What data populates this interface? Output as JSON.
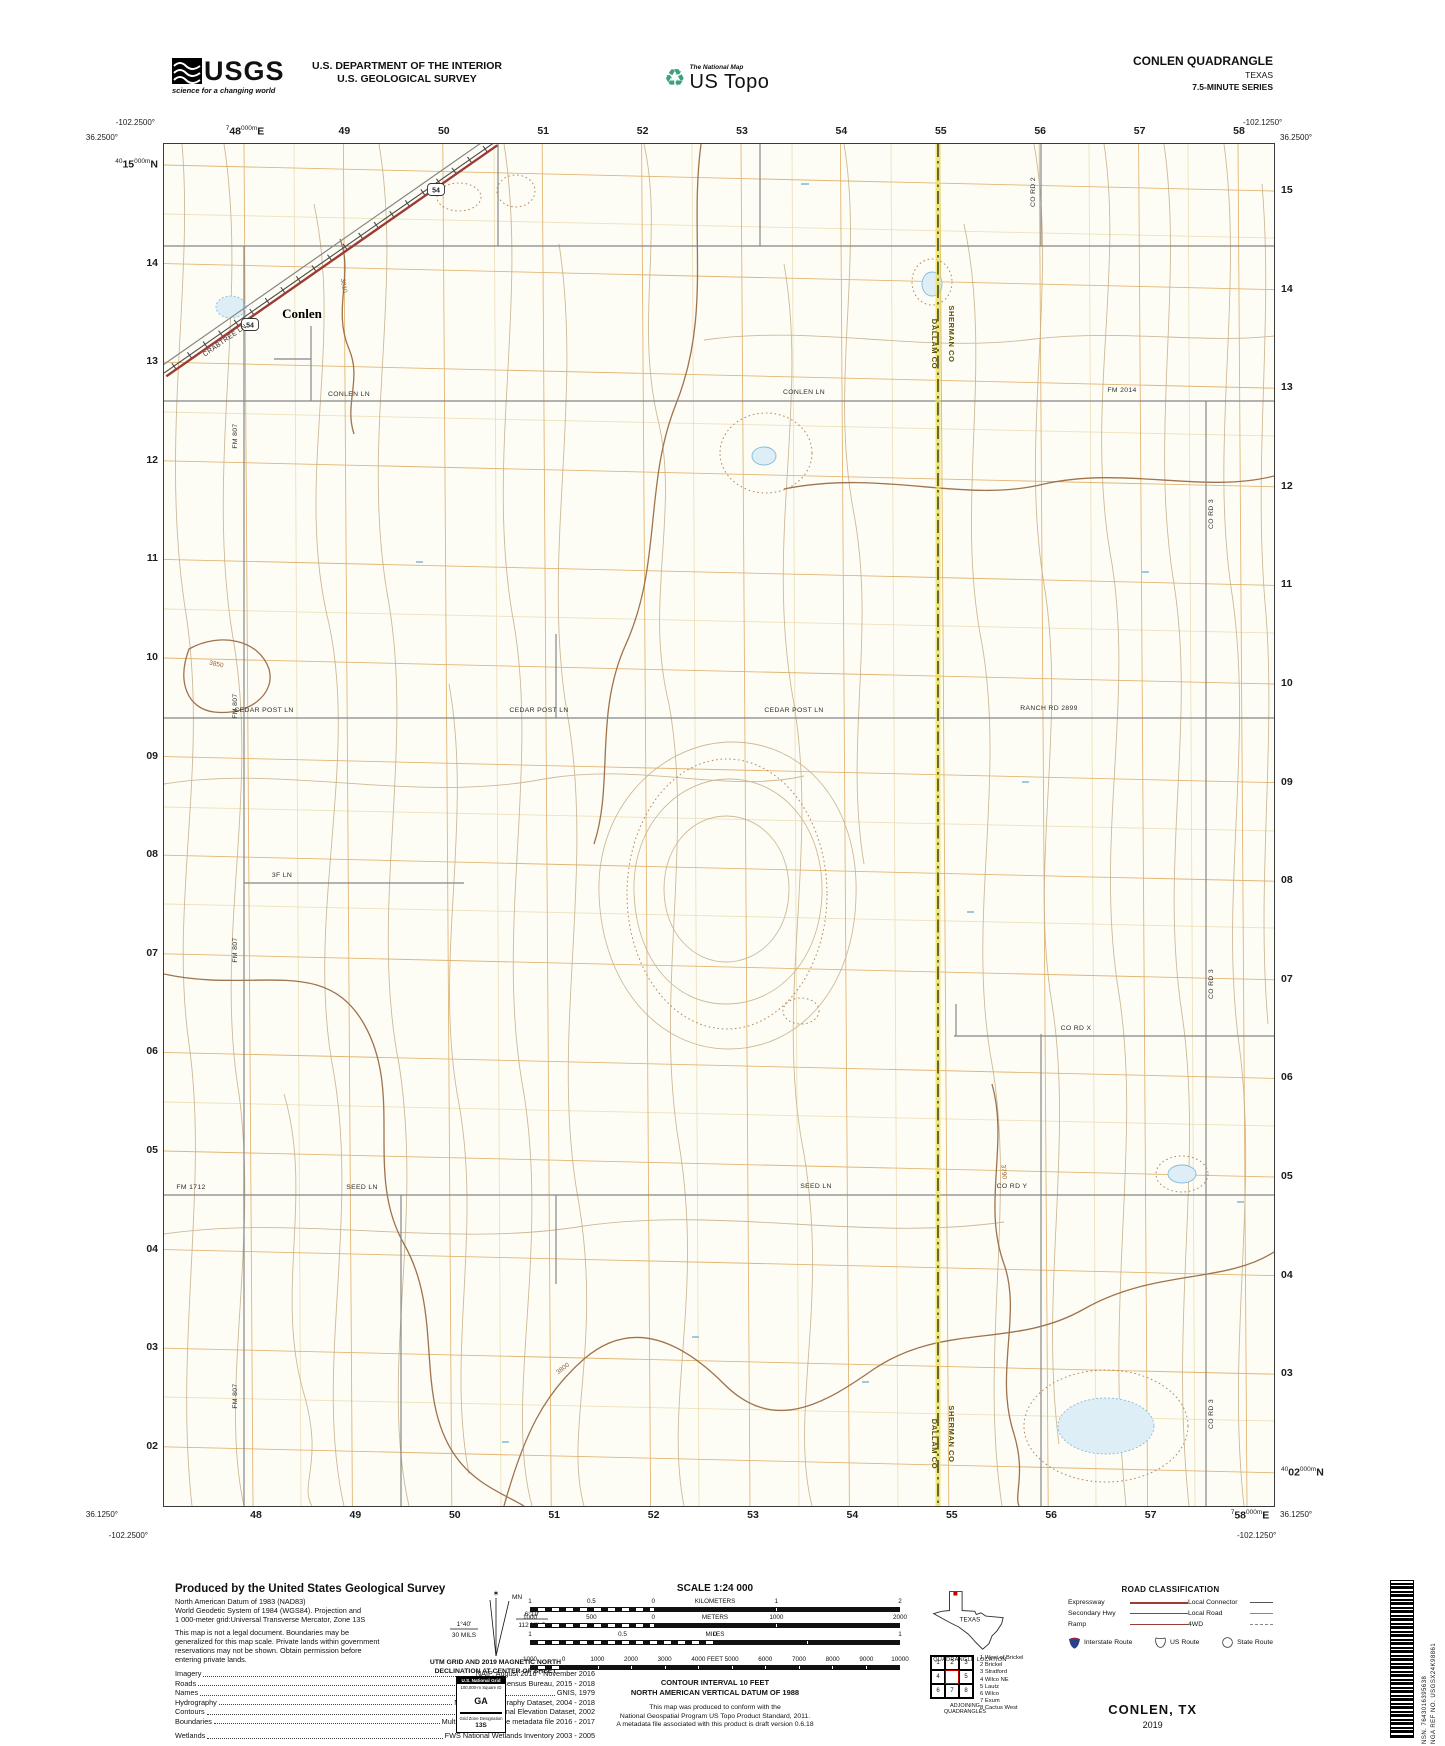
{
  "header": {
    "usgs_word": "USGS",
    "usgs_tagline": "science for a changing world",
    "dept_line1": "U.S. DEPARTMENT OF THE INTERIOR",
    "dept_line2": "U.S. GEOLOGICAL SURVEY",
    "ustopo_small": "The National Map",
    "ustopo_big": "US Topo",
    "quad_title": "CONLEN QUADRANGLE",
    "quad_state": "TEXAS",
    "quad_series": "7.5-MINUTE SERIES"
  },
  "map": {
    "corners": {
      "tl_lon": "-102.2500°",
      "tl_lat": "36.2500°",
      "tr_lon": "-102.1250°",
      "tr_lat": "36.2500°",
      "bl_lat": "36.1250°",
      "bl_lon": "-102.2500°",
      "br_lat": "36.1250°",
      "br_lon": "-102.1250°"
    },
    "grid_top": [
      {
        "pre": "7",
        "main": "48",
        "sup": "000m",
        "post": "E"
      },
      "49",
      "50",
      "51",
      "52",
      "53",
      "54",
      "55",
      "56",
      "57",
      "58"
    ],
    "grid_bottom": [
      "48",
      "49",
      "50",
      "51",
      "52",
      "53",
      "54",
      "55",
      "56",
      "57",
      {
        "pre": "7",
        "main": "58",
        "sup": "000m",
        "post": "E"
      }
    ],
    "grid_left": [
      {
        "pre": "40",
        "main": "15",
        "sup": "000m",
        "post": "N"
      },
      "14",
      "13",
      "12",
      "11",
      "10",
      "09",
      "08",
      "07",
      "06",
      "05",
      "04",
      "03",
      "02"
    ],
    "grid_right": [
      "15",
      "14",
      "13",
      "12",
      "11",
      "10",
      "09",
      "08",
      "07",
      "06",
      "05",
      "04",
      "03",
      {
        "pre": "40",
        "main": "02",
        "sup": "000m",
        "post": "N"
      }
    ],
    "labels": [
      {
        "text": "CONLEN LN",
        "x": 185,
        "y": 252,
        "rot": 0,
        "cls": "road"
      },
      {
        "text": "CONLEN LN",
        "x": 640,
        "y": 250,
        "rot": 0,
        "cls": "road"
      },
      {
        "text": "FM 2014",
        "x": 958,
        "y": 248,
        "rot": 0,
        "cls": "road"
      },
      {
        "text": "CEDAR POST LN",
        "x": 100,
        "y": 568,
        "rot": 0,
        "cls": "road"
      },
      {
        "text": "CEDAR POST LN",
        "x": 375,
        "y": 568,
        "rot": 0,
        "cls": "road"
      },
      {
        "text": "CEDAR POST LN",
        "x": 630,
        "y": 568,
        "rot": 0,
        "cls": "road"
      },
      {
        "text": "RANCH RD 2899",
        "x": 885,
        "y": 566,
        "rot": 0,
        "cls": "road"
      },
      {
        "text": "3F LN",
        "x": 118,
        "y": 733,
        "rot": 0,
        "cls": "road"
      },
      {
        "text": "FM 1712",
        "x": 27,
        "y": 1045,
        "rot": 0,
        "cls": "road"
      },
      {
        "text": "SEED LN",
        "x": 198,
        "y": 1045,
        "rot": 0,
        "cls": "road"
      },
      {
        "text": "SEED LN",
        "x": 652,
        "y": 1044,
        "rot": 0,
        "cls": "road"
      },
      {
        "text": "CO RD Y",
        "x": 848,
        "y": 1044,
        "rot": 0,
        "cls": "road"
      },
      {
        "text": "CO RD X",
        "x": 912,
        "y": 886,
        "rot": 0,
        "cls": "road"
      },
      {
        "text": "CO RD 2",
        "x": 871,
        "y": 48,
        "rot": -90,
        "cls": "road"
      },
      {
        "text": "CO RD 3",
        "x": 1049,
        "y": 370,
        "rot": -90,
        "cls": "road"
      },
      {
        "text": "CO RD 3",
        "x": 1049,
        "y": 840,
        "rot": -90,
        "cls": "road"
      },
      {
        "text": "CO RD 3",
        "x": 1049,
        "y": 1270,
        "rot": -90,
        "cls": "road"
      },
      {
        "text": "FM 807",
        "x": 73,
        "y": 292,
        "rot": -90,
        "cls": "road"
      },
      {
        "text": "FM 807",
        "x": 73,
        "y": 562,
        "rot": -90,
        "cls": "road"
      },
      {
        "text": "FM 807",
        "x": 73,
        "y": 806,
        "rot": -90,
        "cls": "road"
      },
      {
        "text": "FM 807",
        "x": 73,
        "y": 1252,
        "rot": -90,
        "cls": "road"
      },
      {
        "text": "CRABTREE LN",
        "x": 62,
        "y": 198,
        "rot": -35,
        "cls": "road"
      },
      {
        "text": "Conlen",
        "x": 138,
        "y": 174,
        "rot": 0,
        "cls": "town"
      },
      {
        "text": "SHERMAN CO",
        "x": 785,
        "y": 190,
        "rot": 90,
        "cls": "county"
      },
      {
        "text": "DALLAM CO",
        "x": 768,
        "y": 200,
        "rot": 90,
        "cls": "county"
      },
      {
        "text": "SHERMAN CO",
        "x": 785,
        "y": 1290,
        "rot": 90,
        "cls": "county"
      },
      {
        "text": "DALLAM CO",
        "x": 768,
        "y": 1300,
        "rot": 90,
        "cls": "county"
      },
      {
        "text": "3810",
        "x": 178,
        "y": 142,
        "rot": 80,
        "cls": "contour"
      },
      {
        "text": "3850",
        "x": 52,
        "y": 522,
        "rot": 12,
        "cls": "contour"
      },
      {
        "text": "3790",
        "x": 838,
        "y": 1028,
        "rot": 85,
        "cls": "contour"
      },
      {
        "text": "3800",
        "x": 400,
        "y": 1226,
        "rot": -38,
        "cls": "contour"
      }
    ],
    "shields": [
      {
        "text": "54",
        "x": 86,
        "y": 181
      },
      {
        "text": "54",
        "x": 272,
        "y": 46
      }
    ],
    "colors": {
      "highway_red": "#9d3a33",
      "road_gray": "#868686",
      "contour_brown": "#c9b28c",
      "index_contour": "#9a6b43",
      "grid_orange": "#dfa95e",
      "county_yellow": "#e9e04e",
      "water_blue": "#86bcd9"
    }
  },
  "footer": {
    "produced_title": "Produced by the United States Geological Survey",
    "produced_lines": [
      "North American Datum of 1983 (NAD83)",
      "World Geodetic System of 1984 (WGS84).  Projection and",
      "1 000-meter grid:Universal Transverse Mercator, Zone 13S",
      "This map is not a legal document. Boundaries may be",
      "generalized for this map scale. Private lands within government",
      "reservations may not be shown. Obtain permission before",
      "entering private lands."
    ],
    "metadata_rows": [
      {
        "label": "Imagery",
        "value": "NAIP, August 2016 - November 2016"
      },
      {
        "label": "Roads",
        "value": "U.S. Census Bureau, 2015 - 2018"
      },
      {
        "label": "Names",
        "value": "GNIS, 1979"
      },
      {
        "label": "Hydrography",
        "value": "National Hydrography Dataset, 2004 - 2018"
      },
      {
        "label": "Contours",
        "value": "National Elevation Dataset, 2002"
      },
      {
        "label": "Boundaries",
        "value": "Multiple sources; see metadata file 2016 - 2017"
      },
      {
        "label": "Wetlands",
        "value": "FWS National Wetlands Inventory 2003 - 2005"
      }
    ],
    "declination": {
      "mn": "MN",
      "gn_deg": "1°40'",
      "gn_mils": "30 MILS",
      "mn_deg": "6°19'",
      "mn_mils": "112 MILS",
      "caption1": "UTM GRID AND 2019 MAGNETIC NORTH",
      "caption2": "DECLINATION AT CENTER OF SHEET"
    },
    "usng": {
      "title": "U.S. National Grid",
      "sub": "100,000-m Square ID",
      "square": "GA",
      "zone_label": "Grid Zone Designation",
      "zone": "13S"
    },
    "scale": {
      "title": "SCALE 1:24 000",
      "km_labels": [
        "1",
        "0.5",
        "0",
        "1",
        "2"
      ],
      "km_word": "KILOMETERS",
      "m_labels": [
        "1000",
        "500",
        "0",
        "1000",
        "2000"
      ],
      "m_word": "METERS",
      "mi_labels": [
        "1",
        "0.5",
        "0",
        "1"
      ],
      "mi_word": "MILES",
      "ft_labels": [
        "1000",
        "0",
        "1000",
        "2000",
        "3000",
        "4000",
        "5000",
        "6000",
        "7000",
        "8000",
        "9000",
        "10000"
      ],
      "ft_word": "FEET",
      "contour_note1": "CONTOUR INTERVAL 10 FEET",
      "contour_note2": "NORTH AMERICAN VERTICAL DATUM OF 1988",
      "std_note": [
        "This map was produced to conform with the",
        "National Geospatial Program US Topo Product Standard, 2011.",
        "A metadata file associated with this product is draft version 0.6.18"
      ]
    },
    "texas": {
      "label": "TEXAS",
      "caption": "QUADRANGLE LOCATION"
    },
    "road_class": {
      "title": "ROAD CLASSIFICATION",
      "rows": [
        {
          "label": "Expressway",
          "style": "expressway"
        },
        {
          "label": "Secondary Hwy",
          "style": "secondary"
        },
        {
          "label": "Ramp",
          "style": "ramp"
        },
        {
          "label": "Local Connector",
          "style": "connector"
        },
        {
          "label": "Local Road",
          "style": "local"
        },
        {
          "label": "4WD",
          "style": "fourwd"
        }
      ],
      "shields": [
        {
          "label": "Interstate Route",
          "icon": "interstate-shield"
        },
        {
          "label": "US Route",
          "icon": "us-route-shield"
        },
        {
          "label": "State Route",
          "icon": "state-route-circle"
        }
      ]
    },
    "adjoining": {
      "cells": [
        "1",
        "2",
        "3",
        "4",
        "",
        "5",
        "6",
        "7",
        "8"
      ],
      "names": [
        "1 West of Brickel",
        "2 Brickel",
        "3 Stratford",
        "4 Wilco NE",
        "5 Lautz",
        "6 Wilco",
        "7 Exum",
        "8 Cactus West"
      ],
      "caption": "ADJOINING QUADRANGLES"
    },
    "imprint": {
      "title": "CONLEN, TX",
      "year": "2019"
    },
    "barcode": {
      "nsn": "NSN. 7643016395638",
      "ref": "NGA REF NO. USGSX24K98861"
    }
  }
}
